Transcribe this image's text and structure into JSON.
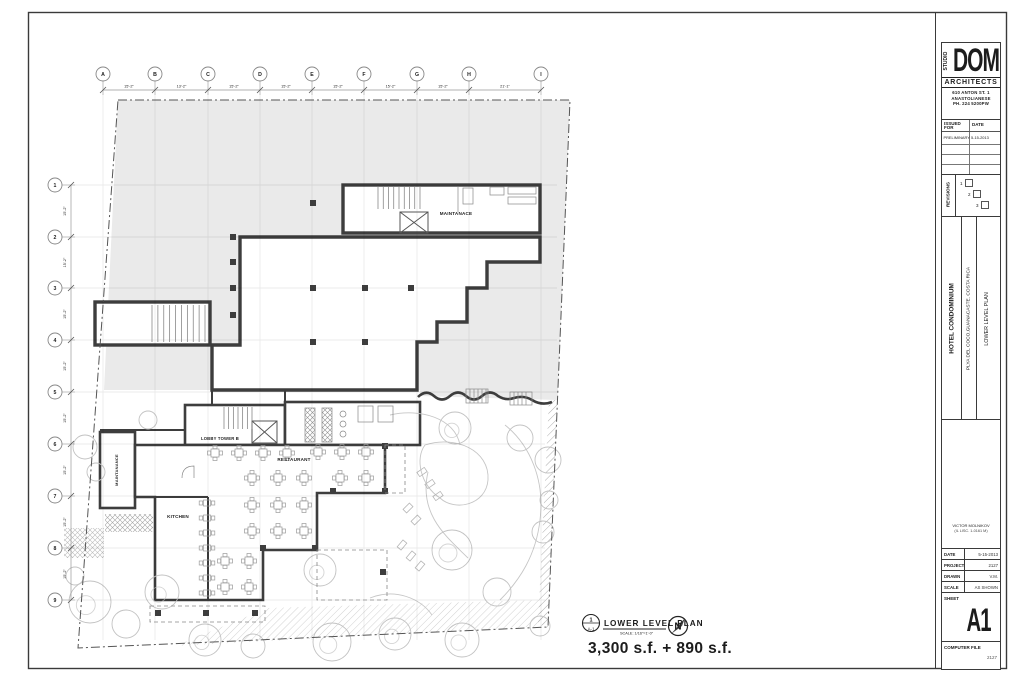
{
  "plan": {
    "grid_columns": [
      "A",
      "B",
      "C",
      "D",
      "E",
      "F",
      "G",
      "H",
      "I"
    ],
    "grid_rows": [
      "1",
      "2",
      "3",
      "4",
      "5",
      "6",
      "7",
      "8",
      "9"
    ],
    "col_dims": [
      "15'-2\"",
      "13'-2\"",
      "15'-2\"",
      "15'-2\"",
      "15'-2\"",
      "15'-2\"",
      "15'-2\"",
      "21'-1\""
    ],
    "row_dims": [
      "15'-2\"",
      "15'-2\"",
      "15'-2\"",
      "15'-2\"",
      "15'-2\"",
      "15'-2\"",
      "15'-2\"",
      "15'-2\""
    ],
    "labels": {
      "maintenance_top": "MAINTANACE",
      "lobby": "LOBBY TOWER B",
      "restaurant": "RESTAURANT",
      "kitchen": "KITCHEN",
      "maintenance_left": "MAINTANANCE"
    },
    "callout": {
      "number": "1",
      "sheet": "A-1",
      "title": "LOWER LEVEL PLAN",
      "scale": "SCALE: 1/16\"=1'-0\"",
      "north": "N"
    },
    "area_text": "3,300 s.f. + 890 s.f."
  },
  "titleblock": {
    "studio": "STUDIO",
    "firm": "DOM",
    "firm_sub": "ARCHITECTS",
    "address_lines": [
      "610 ANTON ST. 1",
      "ANASTOLIANESE",
      "PH. 224 5200PW"
    ],
    "issued_for_label": "ISSUED FOR",
    "date_label": "DATE",
    "issue_rows": [
      {
        "issued": "PRELIMINARY",
        "date": "5-15-2013"
      }
    ],
    "revisions_label": "REVISIONS",
    "revision_numbers": [
      "1",
      "2",
      "3"
    ],
    "project_name": "HOTEL CONDOMINIUM",
    "project_location": "PLYA DEL COCO,GUANACASTE. COSTA RICA",
    "sheet_title": "LOWER LEVEL PLAN",
    "engineer_name": "VICTOR MOLNIKOV",
    "engineer_lic": "(IL LISC. 1-0161 M)",
    "info": {
      "date_label": "DATE",
      "date": "5-15-2013",
      "project_label": "PROJECT",
      "project": "2127",
      "drawn_label": "DRAWN",
      "drawn": "V.M.",
      "scale_label": "SCALE",
      "scale": "AS SHOWN"
    },
    "sheet_label": "SHEET",
    "sheet_number": "A1",
    "computer_file_label": "COMPUTER FILE",
    "computer_file": "2127"
  }
}
